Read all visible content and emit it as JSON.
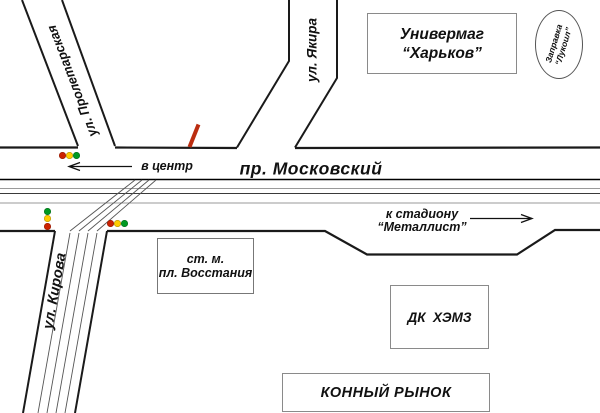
{
  "colors": {
    "red_light": "#cc2200",
    "yellow_light": "#ffcc00",
    "green_light": "#009922",
    "marker": "#bb2d10"
  },
  "streets": {
    "proletarskaya": "ул. Пролетарская",
    "yakira": "ул. Якира",
    "kirova": "ул. Кирова",
    "moskovsky": "пр. Московский"
  },
  "directions": {
    "to_center": "в центр",
    "to_stadium_line1": "к стадиону",
    "to_stadium_line2": "“Металлист”"
  },
  "places": {
    "univermag_line1": "Универмаг",
    "univermag_line2": "“Харьков”",
    "zapravka_line1": "Заправка",
    "zapravka_line2": "“Лукоил”",
    "metro_line1": "ст. м.",
    "metro_line2": "пл. Восстания",
    "dk": "ДК  ХЭМЗ",
    "market": "КОННЫЙ РЫНОК"
  }
}
